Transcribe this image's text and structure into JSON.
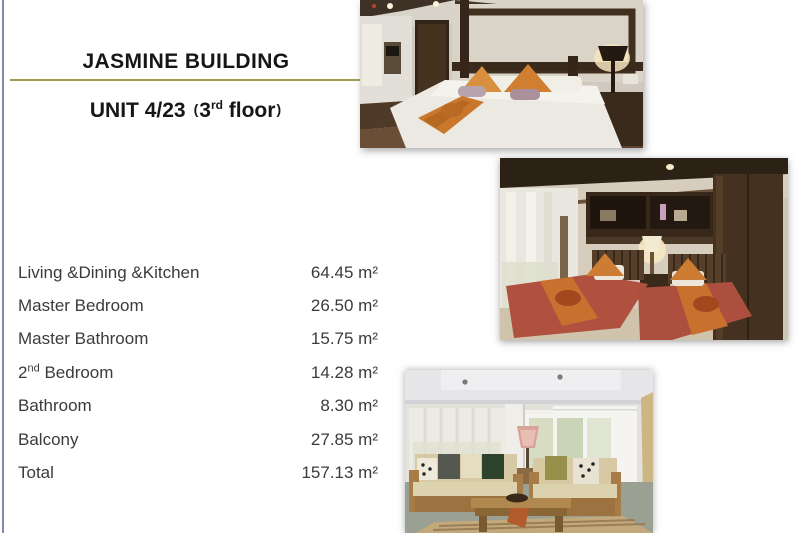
{
  "slide": {
    "title": "JASMINE BUILDING",
    "subtitle": {
      "unit": "UNIT 4/23",
      "open_paren": "(",
      "floor_number": "3",
      "floor_ordinal": "rd",
      "floor_word": " floor",
      "close_paren": ")"
    },
    "colors": {
      "accent_underline": "#a39a52",
      "left_edge_line": "#8289ad",
      "table_text": "#3b3b3b",
      "title_text": "#161616"
    },
    "rooms": [
      {
        "label_pre": "Living &Dining &Kitchen",
        "label_sup": "",
        "label_post": "",
        "area": "64.45 m²"
      },
      {
        "label_pre": "Master Bedroom",
        "label_sup": "",
        "label_post": "",
        "area": "26.50 m²"
      },
      {
        "label_pre": "Master Bathroom",
        "label_sup": "",
        "label_post": "",
        "area": "15.75 m²"
      },
      {
        "label_pre": "2",
        "label_sup": "nd",
        "label_post": " Bedroom",
        "area": "14.28 m²"
      },
      {
        "label_pre": "Bathroom",
        "label_sup": "",
        "label_post": "",
        "area": "8.30 m²"
      },
      {
        "label_pre": "Balcony",
        "label_sup": "",
        "label_post": "",
        "area": "27.85 m²"
      },
      {
        "label_pre": "Total",
        "label_sup": "",
        "label_post": "",
        "area": "157.13 m²"
      }
    ],
    "photos": [
      {
        "name": "master-bedroom-photo"
      },
      {
        "name": "second-bedroom-photo"
      },
      {
        "name": "living-room-photo"
      }
    ]
  }
}
